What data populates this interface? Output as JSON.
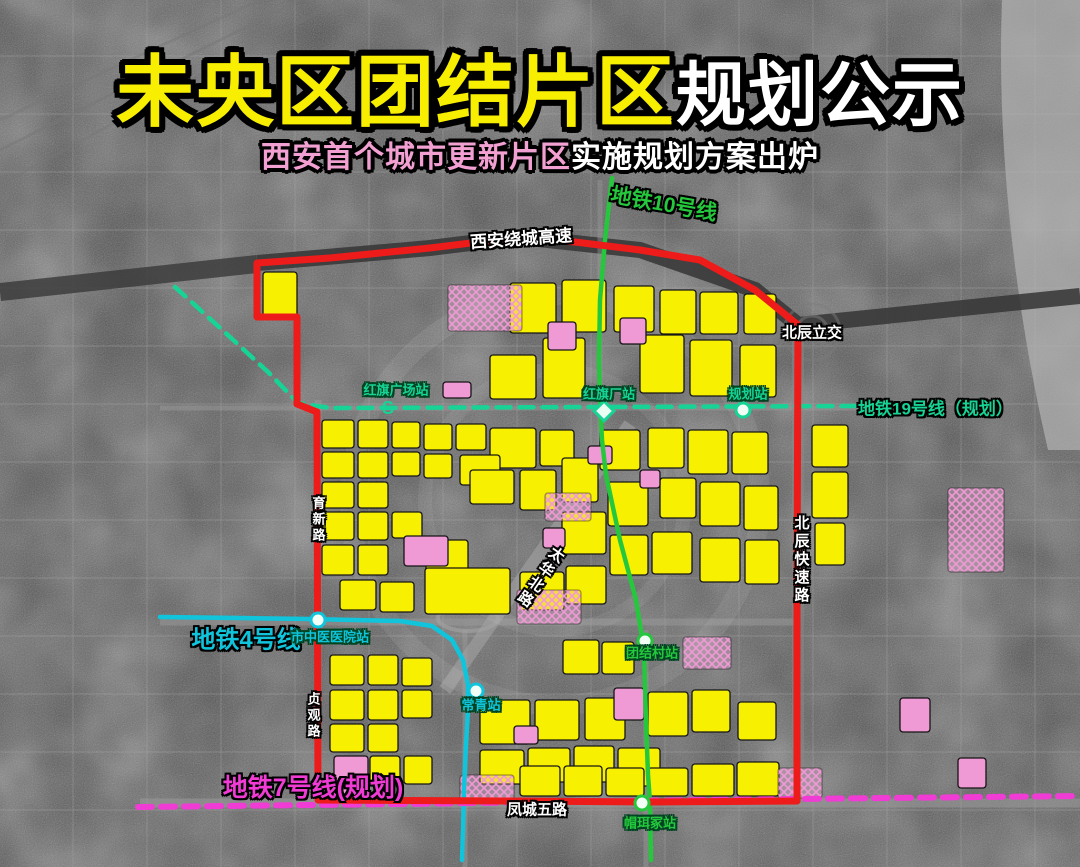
{
  "title": {
    "part1": "未央区团结片区",
    "part2": "规划公示"
  },
  "subtitle": {
    "part1": "西安首个城市更新片区",
    "part2": "实施规划方案出炉"
  },
  "labels": {
    "metro10": "地铁10号线",
    "metro19": "地铁19号线（规划）",
    "metro4": "地铁4号线",
    "metro7": "地铁7号线(规划)",
    "ring_expressway": "西安绕城高速",
    "beichen_interchange": "北辰立交",
    "beichen_expressway": "北辰快速路",
    "yuxin_road": "育新路",
    "zhenguan_road": "贞观路",
    "taihua_road": "太华北路",
    "fengcheng_wulu": "凤城五路"
  },
  "icons": {
    "metro_logo": "S"
  },
  "colors": {
    "title_yellow": "#f8ee00",
    "title_white": "#ffffff",
    "subtitle_pink": "#f2a0d2",
    "boundary_red": "#ee1b1b",
    "parcel_yellow": "#f7f000",
    "parcel_pink": "#f09ad5",
    "m10": "#25c73c",
    "m19": "#17d395",
    "m4": "#10c4dc",
    "m7": "#f03cd4"
  },
  "map_overlay": {
    "boundary": "M257,263 L257,317 L297,317 L297,404 L317,412 L318,800 L510,801 L650,802 L797,801 L797,592 L798,325 L755,290 L700,260 L640,250 L575,242 L520,237 L430,248 L330,258 Z",
    "lines": [
      {
        "id": "m10",
        "points": "612,178 605,240 600,300 599,360 600,400 602,440 606,475 620,540 636,600 644,650 646,720 648,775 650,803 651,860",
        "dashed": false
      },
      {
        "id": "m19",
        "points": "175,287 230,337 268,372 298,403 330,408 855,406",
        "dashed": true
      },
      {
        "id": "m4",
        "points": "160,617 240,618 310,619 400,621 432,626 452,640 463,660 468,685 468,710 466,745 464,790 463,830 462,860",
        "dashed": false
      },
      {
        "id": "m7",
        "points": "138,807 400,804 700,800 1080,796",
        "dashed": true
      }
    ],
    "stations": [
      {
        "name": "红旗广场站",
        "x": 388,
        "y": 408,
        "marker": "logo",
        "line": "m19",
        "lx": 396,
        "ly": 389
      },
      {
        "name": "红旗厂站",
        "x": 604,
        "y": 411,
        "marker": "diamond",
        "line": "m19",
        "lx": 609,
        "ly": 393
      },
      {
        "name": "规划站",
        "x": 743,
        "y": 410,
        "marker": "ring",
        "line": "m19",
        "lx": 748,
        "ly": 393
      },
      {
        "name": "团结村站",
        "x": 645,
        "y": 641,
        "marker": "ring",
        "line": "m10",
        "lx": 652,
        "ly": 652
      },
      {
        "name": "帽珥冢站",
        "x": 642,
        "y": 803,
        "marker": "ring",
        "line": "m10",
        "lx": 650,
        "ly": 822
      },
      {
        "name": "市中医医院站",
        "x": 318,
        "y": 620,
        "marker": "ring",
        "line": "m4",
        "lx": 330,
        "ly": 636
      },
      {
        "name": "常青站",
        "x": 476,
        "y": 691,
        "marker": "ring",
        "line": "m4",
        "lx": 481,
        "ly": 704
      }
    ],
    "parcels": [
      [
        263,
        272,
        34,
        46,
        "y"
      ],
      [
        510,
        283,
        46,
        50,
        "y"
      ],
      [
        562,
        280,
        44,
        52,
        "y"
      ],
      [
        614,
        286,
        40,
        46,
        "y"
      ],
      [
        660,
        290,
        36,
        44,
        "y"
      ],
      [
        700,
        292,
        38,
        42,
        "y"
      ],
      [
        744,
        294,
        32,
        40,
        "y"
      ],
      [
        490,
        355,
        46,
        44,
        "y"
      ],
      [
        543,
        338,
        42,
        60,
        "y"
      ],
      [
        640,
        335,
        44,
        58,
        "y"
      ],
      [
        690,
        340,
        42,
        56,
        "y"
      ],
      [
        740,
        345,
        36,
        52,
        "y"
      ],
      [
        322,
        420,
        32,
        28,
        "y"
      ],
      [
        358,
        420,
        30,
        28,
        "y"
      ],
      [
        392,
        422,
        28,
        26,
        "y"
      ],
      [
        424,
        424,
        28,
        26,
        "y"
      ],
      [
        456,
        424,
        30,
        26,
        "y"
      ],
      [
        490,
        428,
        46,
        40,
        "y"
      ],
      [
        540,
        430,
        34,
        36,
        "y"
      ],
      [
        322,
        452,
        32,
        26,
        "y"
      ],
      [
        358,
        452,
        30,
        26,
        "y"
      ],
      [
        392,
        452,
        28,
        24,
        "y"
      ],
      [
        424,
        454,
        28,
        24,
        "y"
      ],
      [
        322,
        482,
        32,
        26,
        "y"
      ],
      [
        358,
        482,
        30,
        26,
        "y"
      ],
      [
        460,
        455,
        40,
        30,
        "y"
      ],
      [
        470,
        470,
        44,
        34,
        "y"
      ],
      [
        520,
        470,
        36,
        40,
        "y"
      ],
      [
        562,
        458,
        36,
        44,
        "y"
      ],
      [
        600,
        430,
        40,
        40,
        "y"
      ],
      [
        648,
        428,
        36,
        40,
        "y"
      ],
      [
        688,
        430,
        40,
        44,
        "y"
      ],
      [
        732,
        432,
        36,
        42,
        "y"
      ],
      [
        608,
        482,
        40,
        44,
        "y"
      ],
      [
        660,
        478,
        36,
        40,
        "y"
      ],
      [
        700,
        482,
        40,
        44,
        "y"
      ],
      [
        744,
        486,
        34,
        44,
        "y"
      ],
      [
        322,
        512,
        32,
        28,
        "y"
      ],
      [
        358,
        512,
        30,
        28,
        "y"
      ],
      [
        392,
        512,
        30,
        26,
        "y"
      ],
      [
        322,
        545,
        32,
        30,
        "y"
      ],
      [
        358,
        545,
        30,
        30,
        "y"
      ],
      [
        426,
        540,
        42,
        34,
        "y"
      ],
      [
        562,
        512,
        44,
        42,
        "y"
      ],
      [
        610,
        535,
        38,
        40,
        "y"
      ],
      [
        652,
        532,
        40,
        42,
        "y"
      ],
      [
        700,
        538,
        40,
        44,
        "y"
      ],
      [
        745,
        540,
        34,
        44,
        "y"
      ],
      [
        340,
        580,
        36,
        30,
        "y"
      ],
      [
        380,
        582,
        34,
        30,
        "y"
      ],
      [
        425,
        568,
        85,
        46,
        "y"
      ],
      [
        520,
        572,
        44,
        38,
        "y"
      ],
      [
        566,
        566,
        40,
        38,
        "y"
      ],
      [
        563,
        640,
        36,
        34,
        "y"
      ],
      [
        602,
        642,
        32,
        32,
        "y"
      ],
      [
        330,
        655,
        34,
        30,
        "y"
      ],
      [
        368,
        655,
        30,
        30,
        "y"
      ],
      [
        402,
        658,
        30,
        28,
        "y"
      ],
      [
        330,
        690,
        34,
        30,
        "y"
      ],
      [
        368,
        690,
        30,
        30,
        "y"
      ],
      [
        402,
        690,
        30,
        28,
        "y"
      ],
      [
        330,
        724,
        34,
        28,
        "y"
      ],
      [
        368,
        724,
        30,
        28,
        "y"
      ],
      [
        480,
        700,
        50,
        44,
        "y"
      ],
      [
        535,
        700,
        44,
        40,
        "y"
      ],
      [
        585,
        698,
        40,
        42,
        "y"
      ],
      [
        648,
        692,
        40,
        44,
        "y"
      ],
      [
        692,
        690,
        38,
        42,
        "y"
      ],
      [
        738,
        702,
        38,
        38,
        "y"
      ],
      [
        480,
        750,
        44,
        34,
        "y"
      ],
      [
        528,
        748,
        42,
        34,
        "y"
      ],
      [
        574,
        746,
        40,
        36,
        "y"
      ],
      [
        618,
        748,
        42,
        38,
        "y"
      ],
      [
        370,
        756,
        30,
        30,
        "y"
      ],
      [
        404,
        756,
        28,
        28,
        "y"
      ],
      [
        520,
        766,
        40,
        30,
        "y"
      ],
      [
        564,
        766,
        38,
        30,
        "y"
      ],
      [
        606,
        768,
        38,
        28,
        "y"
      ],
      [
        648,
        768,
        40,
        28,
        "y"
      ],
      [
        692,
        764,
        42,
        32,
        "y"
      ],
      [
        737,
        762,
        42,
        34,
        "y"
      ],
      [
        812,
        425,
        36,
        42,
        "y"
      ],
      [
        812,
        472,
        36,
        46,
        "y"
      ],
      [
        815,
        523,
        30,
        42,
        "y"
      ],
      [
        548,
        322,
        28,
        28,
        "p"
      ],
      [
        620,
        318,
        26,
        26,
        "p"
      ],
      [
        443,
        382,
        28,
        16,
        "p"
      ],
      [
        404,
        536,
        44,
        30,
        "p"
      ],
      [
        543,
        528,
        22,
        20,
        "p"
      ],
      [
        588,
        446,
        24,
        18,
        "p"
      ],
      [
        640,
        470,
        20,
        18,
        "p"
      ],
      [
        334,
        756,
        34,
        42,
        "p"
      ],
      [
        514,
        726,
        24,
        18,
        "p"
      ],
      [
        614,
        688,
        30,
        32,
        "p"
      ],
      [
        900,
        698,
        30,
        34,
        "p"
      ],
      [
        958,
        758,
        28,
        30,
        "p"
      ],
      [
        448,
        285,
        74,
        46,
        "x"
      ],
      [
        545,
        493,
        46,
        28,
        "x"
      ],
      [
        517,
        590,
        64,
        34,
        "x"
      ],
      [
        683,
        637,
        48,
        32,
        "x"
      ],
      [
        460,
        775,
        54,
        26,
        "x"
      ],
      [
        778,
        768,
        44,
        30,
        "x"
      ],
      [
        948,
        488,
        56,
        84,
        "x"
      ]
    ]
  }
}
